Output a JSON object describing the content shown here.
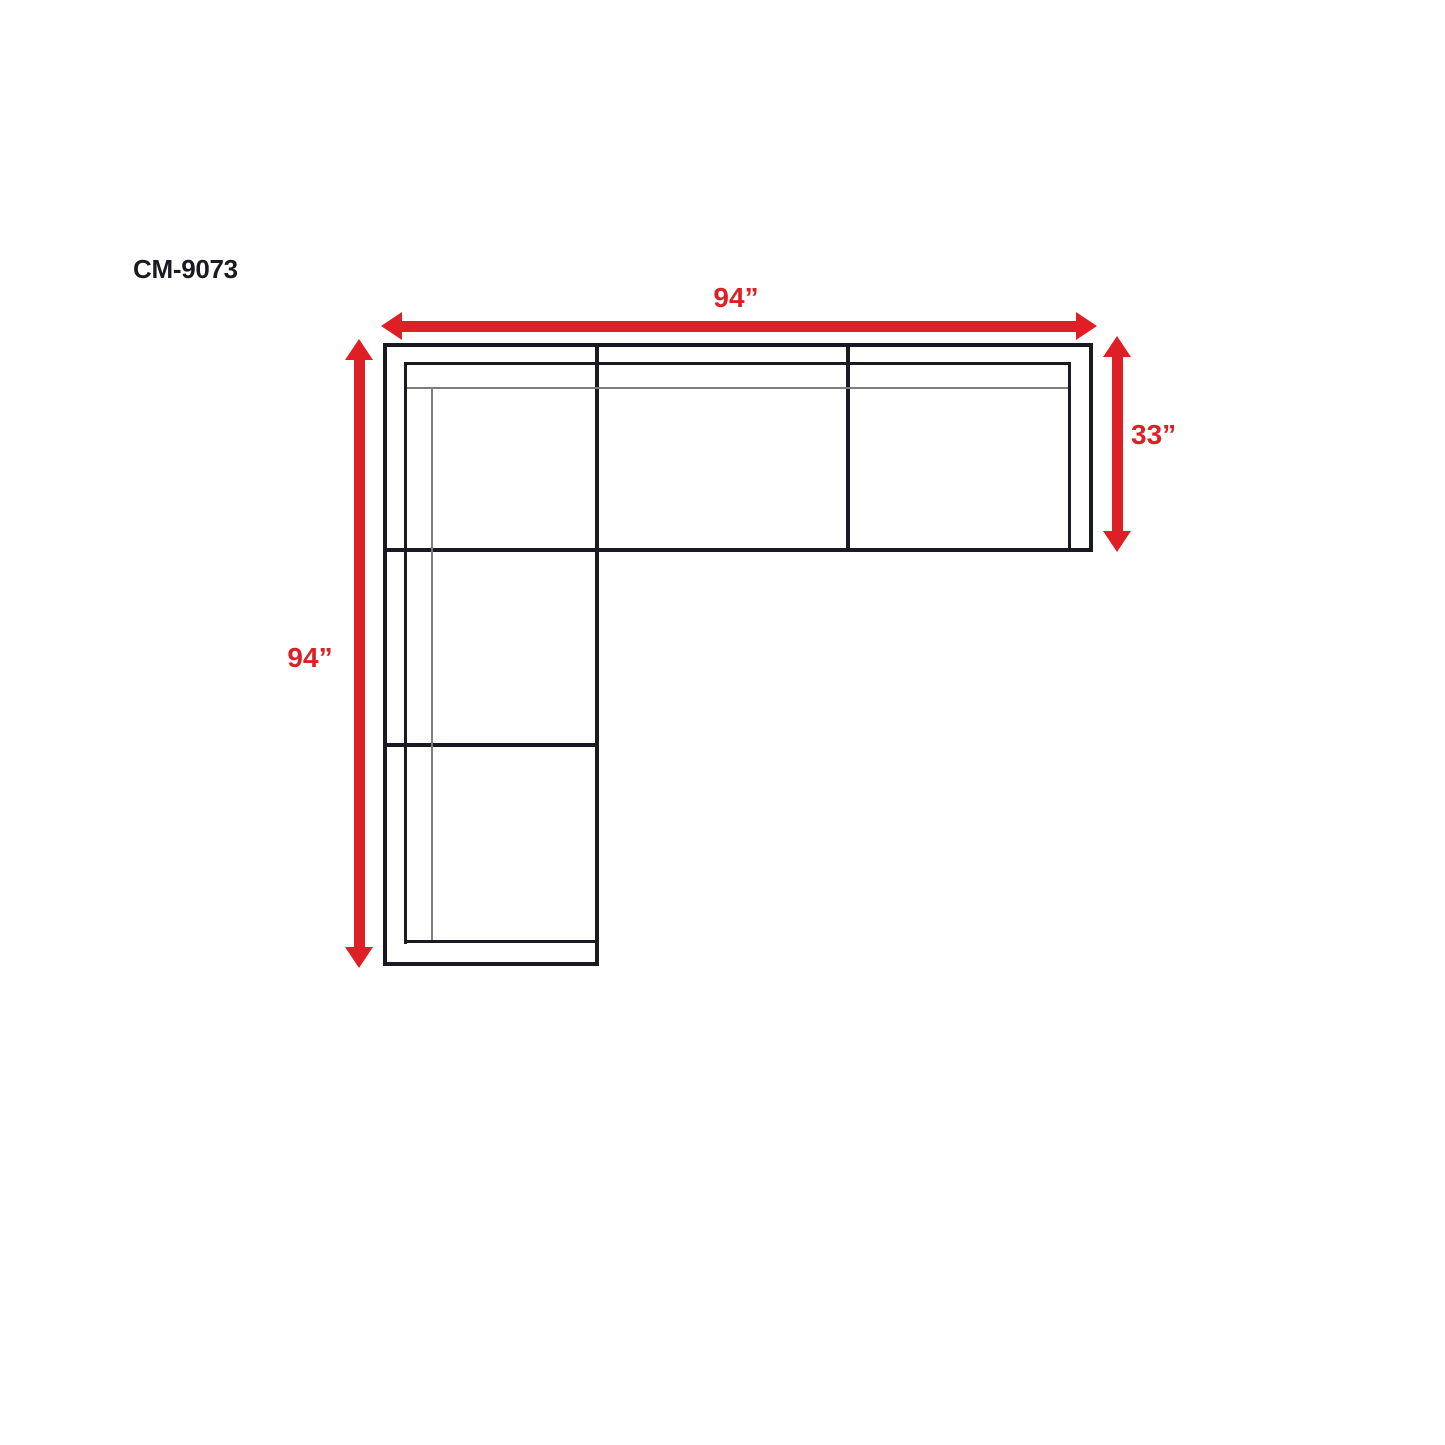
{
  "page": {
    "title": "CM-9073"
  },
  "colors": {
    "dimension_red": "#df1f26",
    "line_black": "#1a1a22",
    "thin_gray": "#7d7d7d",
    "background": "#ffffff"
  },
  "diagram": {
    "type": "sectional-sofa-top-view-dimension-drawing",
    "sections": "L-shaped sectional: 3-seat top band, 3-seat left band sharing corner seat",
    "dimensions": [
      {
        "id": "overall-width-top",
        "label": "94”",
        "value_inches": 94,
        "edge": "top"
      },
      {
        "id": "depth-right",
        "label": "33”",
        "value_inches": 33,
        "edge": "right"
      },
      {
        "id": "overall-length-left",
        "label": "94”",
        "value_inches": 94,
        "edge": "left"
      }
    ]
  }
}
